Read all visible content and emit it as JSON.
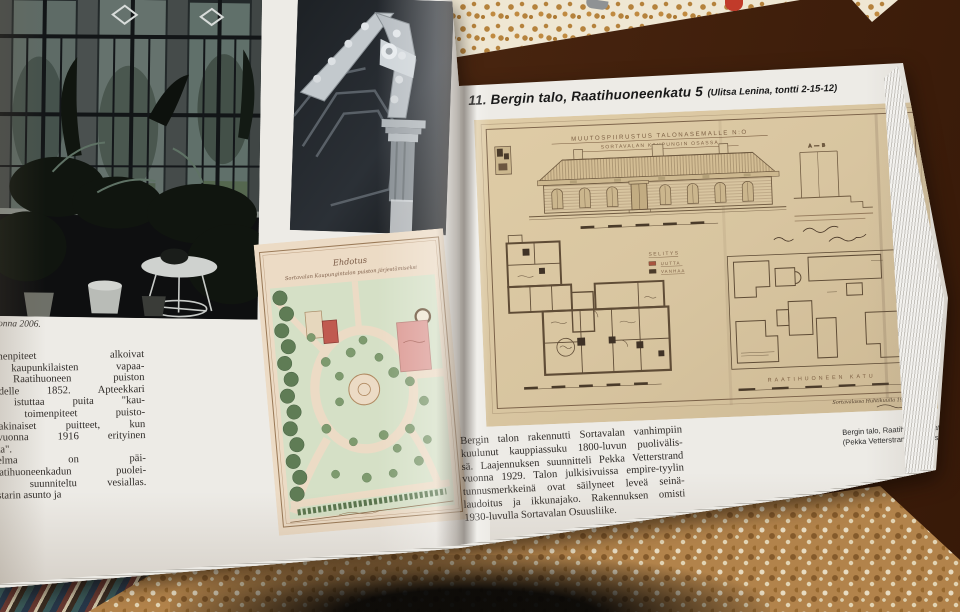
{
  "left_page": {
    "photo_caption_fragment": "onna 2006.",
    "body_lines": [
      "aunistamistoimenpiteet  alkoivat",
      "sityisten kaupunkilaisten vapaa-",
      "innasta.  Raatihuoneen  puiston",
      "ttuu vuodelle 1852. Apteekkari",
      "htäväkseen istuttaa puita \"kau-",
      "Kaupungin toimenpiteet puisto-",
      "saivat vakinaiset puitteet, kun",
      "stettiin vuonna 1916 erityinen",
      "uistovaliokunta\".",
      "  puistosuunnitelma  on  päi-",
      ".  Raatihuoneenkadun  puolei-",
      "teen oli suunniteltu vesiallas.",
      "sivat vahtimestarin asunto ja"
    ]
  },
  "park_plan": {
    "title_line1": "Ehdotus",
    "title_line2": "Sortavalan Kaupungintalon puiston järjestämiseksi"
  },
  "right_page": {
    "heading": "11. Bergin talo, Raatihuoneenkatu 5",
    "heading_sub": "(Ulitsa Lenina, tontti 2-15-12)",
    "body_lines": [
      "Bergin talon rakennutti Sortavalan vanhimpiin",
      "kuulunut kauppiassuku 1800-luvun puolivälis-",
      "sä. Laajennuksen suunnitteli Pekka Vetterstrand",
      "vuonna 1929. Talon julkisivuissa empire-tyylin",
      "tunnusmerkkeinä ovat säilyneet leveä seinä-",
      "laudoitus ja ikkunajako. Rakennuksen omisti",
      "1930-luvulla Sortavalan Osuusliike."
    ],
    "caption_line1": "Bergin talo, Raatihuoneenkatu 5",
    "caption_line2": "(Pekka Vetterstrand, muutos 192"
  },
  "drawing": {
    "title_line1": "MUUTOSPIIRUSTUS TALONASEMALLE N:O",
    "title_line2": "SORTAVALAN KAUPUNGIN OSASSA",
    "legend_title": "SELITYS",
    "legend_new": "UUTTA",
    "legend_old": "VANHAA",
    "section_label": "A — B",
    "street_horizontal": "RAATIHUONEEN KATU",
    "street_vertical": "KARJALAN KATU",
    "handwritten_date": "Sortavalassa Huhtikuulla 1929"
  },
  "colors": {
    "table_brown": "#47240f",
    "cloth_gold": "#b5823c",
    "page_cream": "#edebe6",
    "drawing_tan": "#dbc8a2",
    "drawing_ink": "#6b5640",
    "plan_pink": "#dc9a94",
    "plan_green": "#7e9a6e",
    "photo_dark": "#16181a",
    "accent_red": "#c13b2a"
  }
}
